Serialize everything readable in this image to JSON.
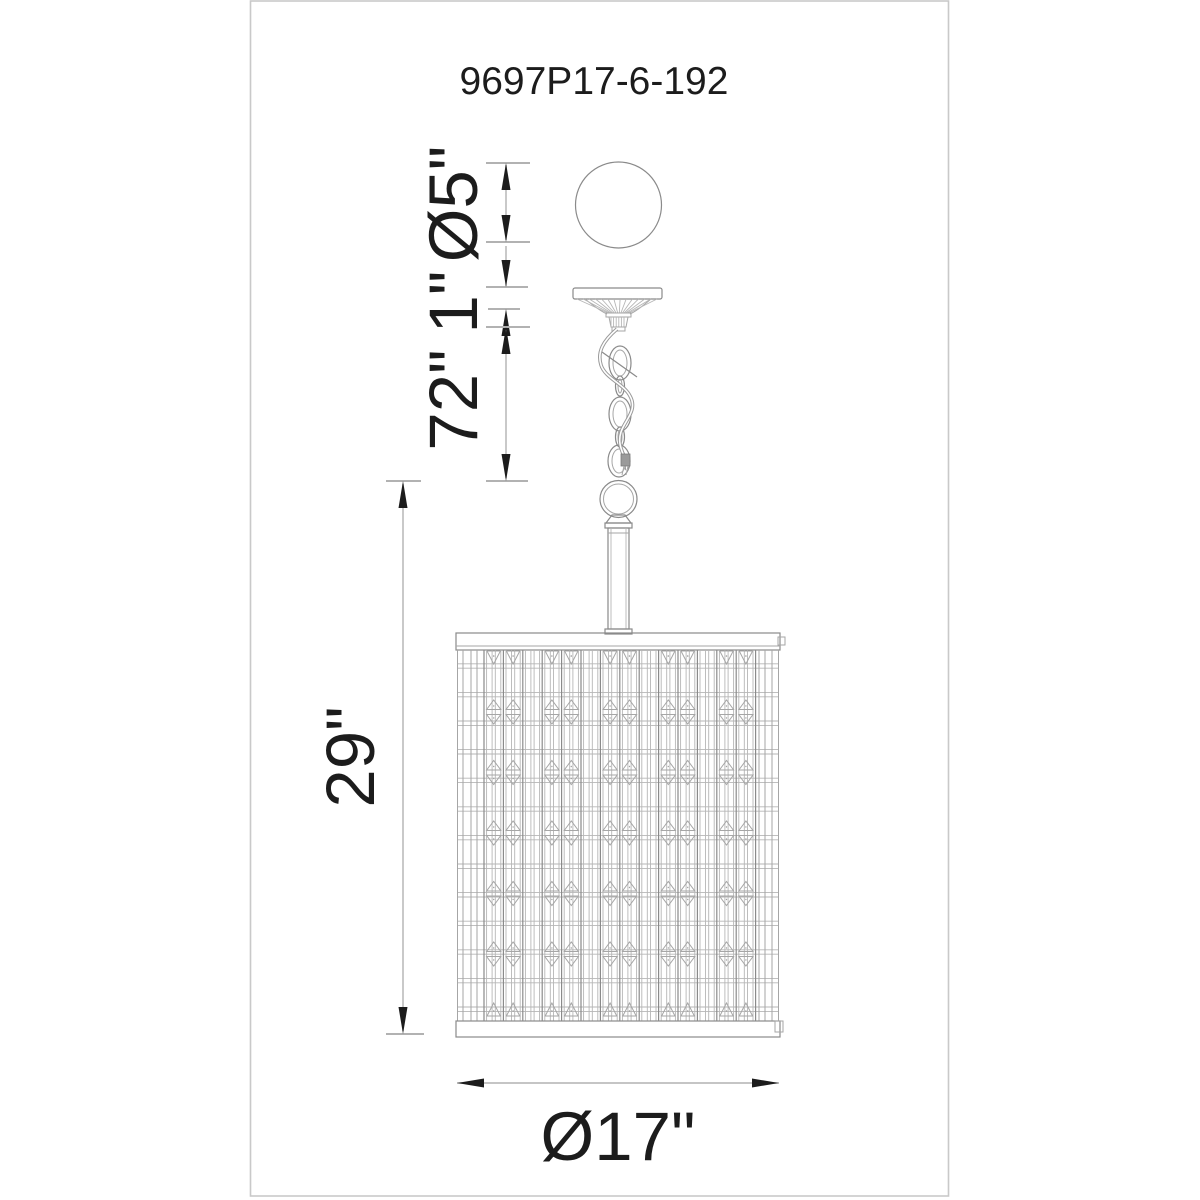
{
  "drawing": {
    "product_code": "9697P17-6-192",
    "type": "pendant-light-line-drawing",
    "dimensions": {
      "canopy_diameter": "Ø5\"",
      "canopy_height": "1\"",
      "chain_length": "72\"",
      "fixture_height": "29\"",
      "shade_diameter": "Ø17\""
    },
    "colors": {
      "ink": "#1c1c1c",
      "drawing_line": "#8a8a8a",
      "dimension_line": "#b2b2b2",
      "frame_border": "#c9c9c9",
      "background": "#ffffff"
    }
  }
}
